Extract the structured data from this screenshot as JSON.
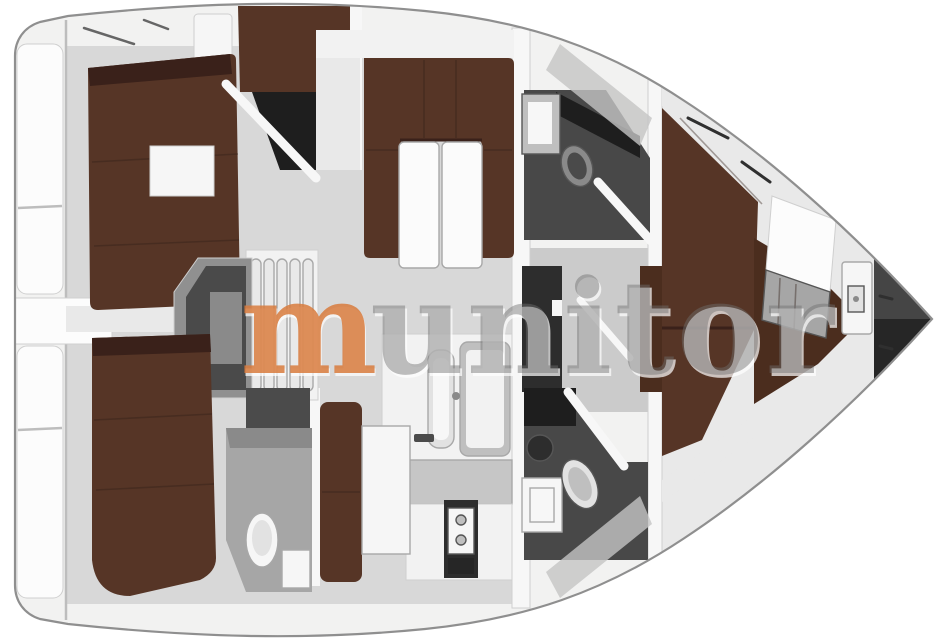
{
  "watermark": {
    "first_letter": "m",
    "rest": "unitor"
  },
  "colors": {
    "background": "#ffffff",
    "hull_line": "#8f8f8f",
    "deck": "#f2f2f1",
    "shade_gray": "#c4c4c4",
    "platform": "#fcfcfc",
    "bulkhead": "#f7f7f7",
    "wall_gray": "#e9e9e9",
    "sole": "#d8d8d8",
    "sole_fwd": "#e9e9e9",
    "corridor": "#cbcbcb",
    "berth": "#563526",
    "berth_shadow": "#3a211a",
    "wood_floor": "#4b2d1e",
    "wet_floor": "#484848",
    "wet_floor_light": "#a6a6a6",
    "wet_dark": "#1e1e1e",
    "counter_white": "#f2f2f2",
    "counter_gray": "#c6c6c6",
    "table_white": "#fbfbfb",
    "fixture_white": "#f6f6f6",
    "fixture_gray": "#bfbfbf",
    "inset_light": "#f7f7f7",
    "inset_gray": "#e2e2e2",
    "metal_gray": "#8a8a8a",
    "engine_frame": "#909090",
    "engine_dark": "#4a4a4a",
    "step": "#e9e9e9",
    "door_dark": "#4b4b4b",
    "appliance_dark": "#2d2d2d",
    "locker_dark": "#262626",
    "locker_high": "#454545",
    "accent_orange": "#d97c3e",
    "watermark_gray": "rgba(110,110,110,0.45)",
    "watermark_highlight": "rgba(255,255,255,0.7)"
  }
}
